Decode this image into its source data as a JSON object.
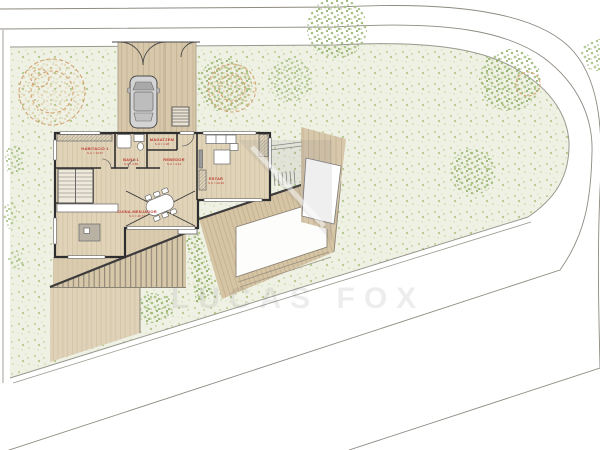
{
  "watermark": {
    "brand": "LUCAS FOX"
  },
  "rooms": [
    {
      "key": "habitacio-1",
      "label": "HABITACIÓ 1",
      "area": "S.U = 10.97"
    },
    {
      "key": "bany-1",
      "label": "BANY 1",
      "area": "S.U = 4.86"
    },
    {
      "key": "magatzem",
      "label": "MAGATZEM",
      "area": "S.U = 1.98"
    },
    {
      "key": "rebedor",
      "label": "REBEDOR",
      "area": "S.U = 4.14"
    },
    {
      "key": "estar",
      "label": "ESTAR",
      "area": "S.U = 20.46"
    },
    {
      "key": "cuina-menjador",
      "label": "CUINA-MENJADOR",
      "area": "S.U = 40.77"
    }
  ],
  "colors": {
    "label_red": "#bf3b30",
    "wall": "#2e2e2e",
    "wood": "#d8c8ab",
    "wood_light": "#e0d3b8",
    "grass_base": "#eff1e4",
    "foliage": "#9db974",
    "tree_outline": "#d2a176",
    "boundary_line": "#8f8a82"
  }
}
